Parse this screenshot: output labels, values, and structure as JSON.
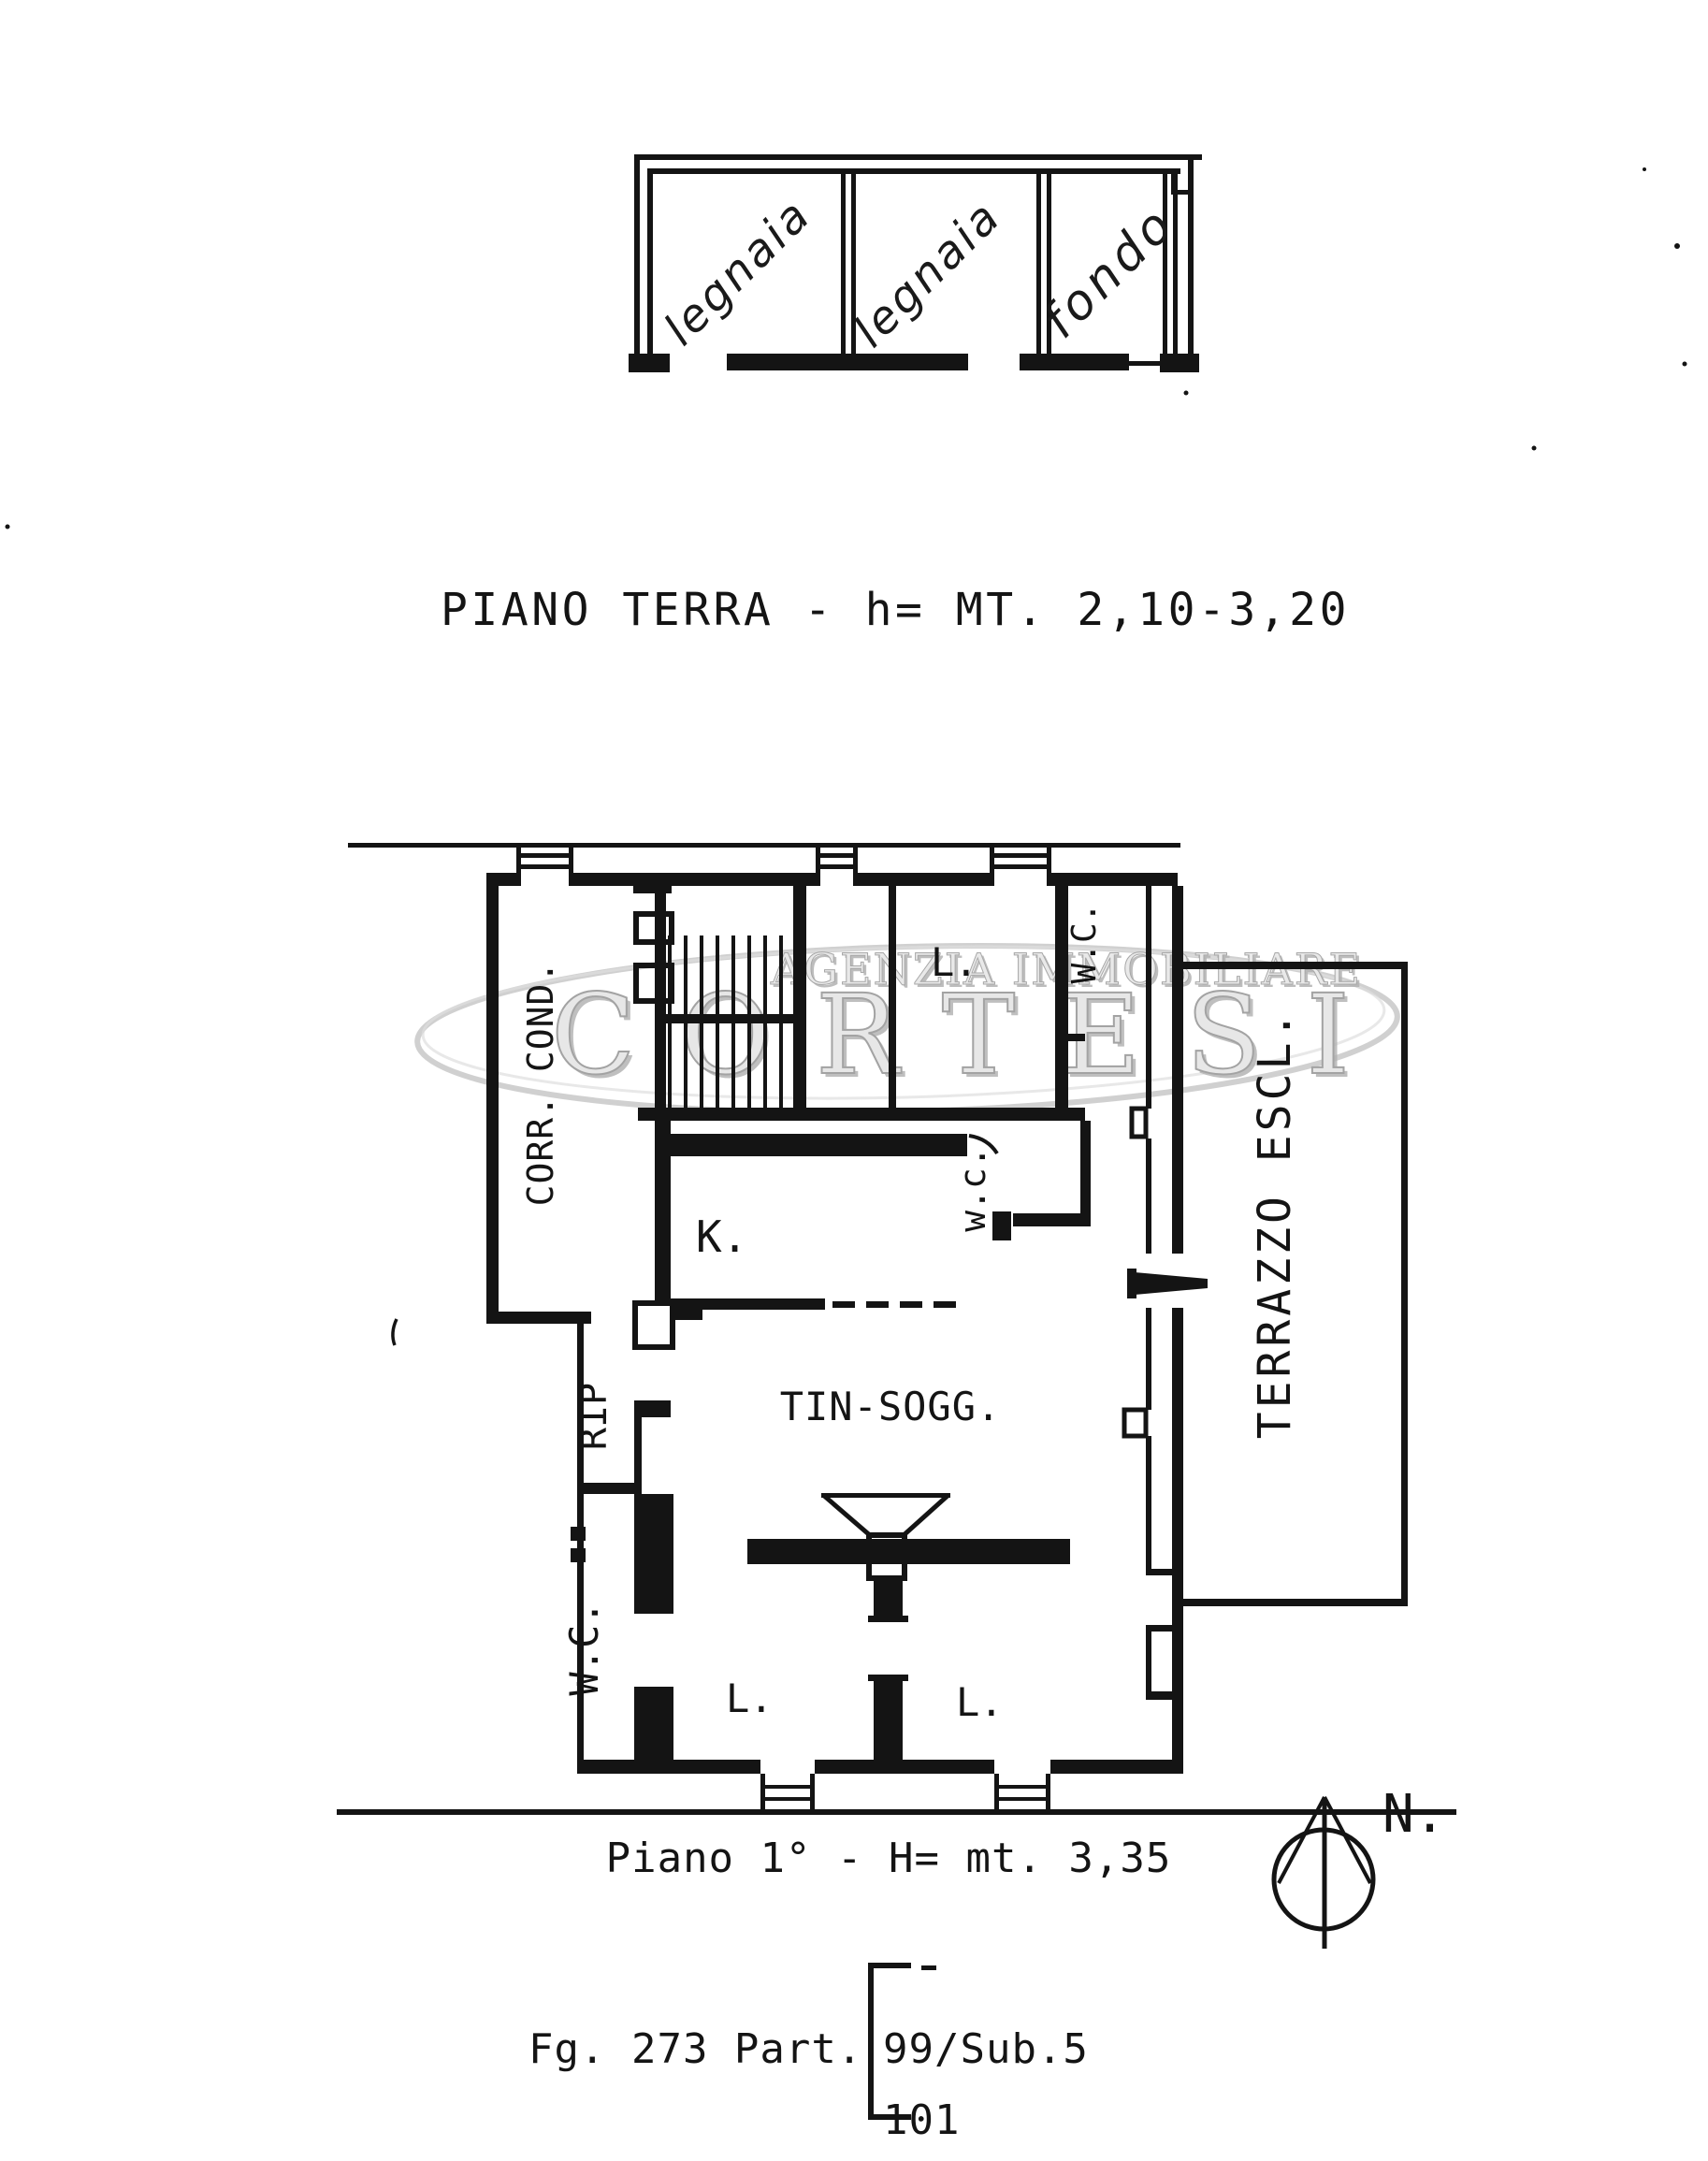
{
  "colors": {
    "ink": "#141414",
    "watermark_gray": "#b6b6b6"
  },
  "ground_floor": {
    "room_labels": [
      "legnaia",
      "legnaia",
      "fondo"
    ],
    "caption": "PIANO TERRA - h= MT. 2,10-3,20"
  },
  "watermark": {
    "agency": "AGENZIA IMMOBILIARE",
    "brand": "CORTESI"
  },
  "first_floor": {
    "caption": "Piano 1° - H= mt. 3,35",
    "room_labels": {
      "corridor": "CORR. COND.",
      "bedroom_top": "L.",
      "wc_top": "W.C.",
      "wc_mid": "w.c.",
      "kitchen": "K.",
      "living": "TIN-SOGG.",
      "storage": "RIP",
      "wc_bottom": "W.C.",
      "bedroom_left": "L.",
      "bedroom_right": "L.",
      "terrace": "TERRAZZO ESCL."
    }
  },
  "compass": {
    "north": "N."
  },
  "cadastral": {
    "sheet": "Fg. 273 Part.",
    "sub": "99/Sub.5",
    "parcel": "101"
  }
}
